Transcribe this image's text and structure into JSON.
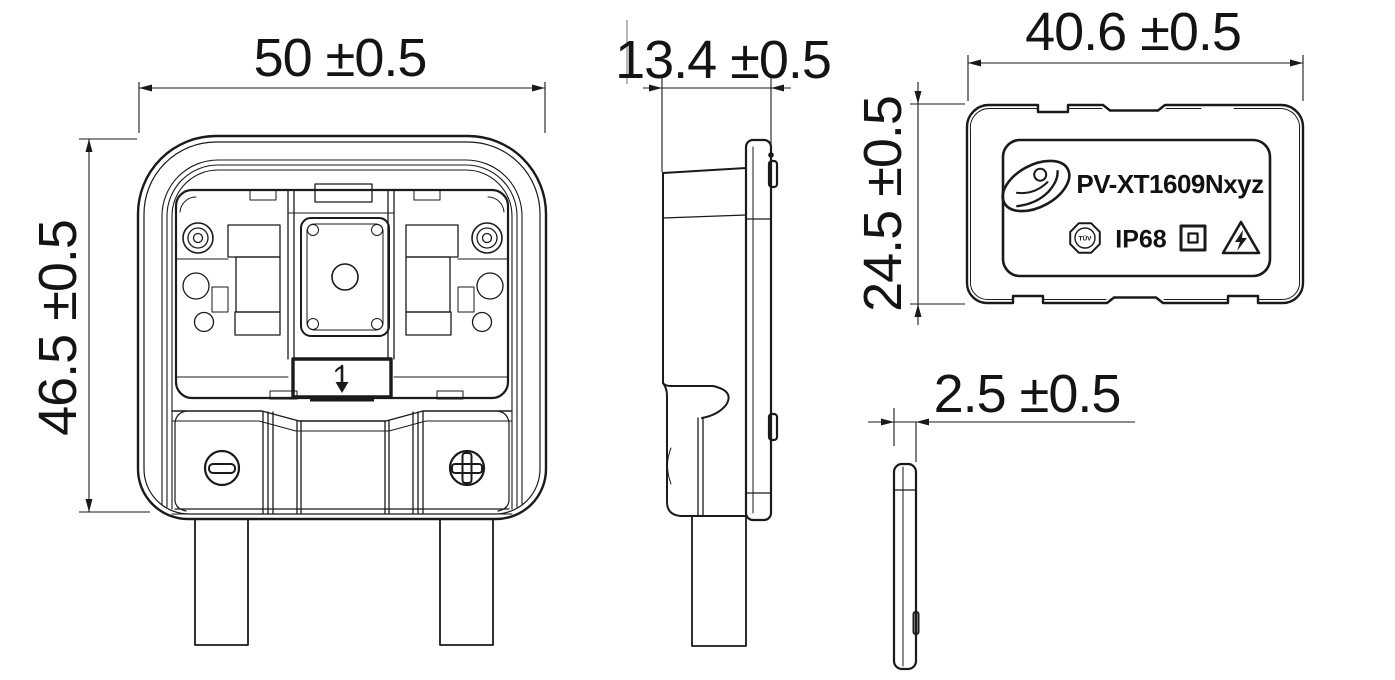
{
  "drawing": {
    "product": {
      "code": "PV-XT1609Nxyz",
      "ip_rating": "IP68",
      "tuv_mark": "TÜV"
    },
    "dimensions": {
      "front_width": "50 ±0.5",
      "front_height": "46.5 ±0.5",
      "side_depth": "13.4 ±0.5",
      "back_width": "40.6 ±0.5",
      "back_height": "24.5 ±0.5",
      "flange_thickness": "2.5 ±0.5"
    },
    "colors": {
      "line": "#1a1a1a",
      "background": "#ffffff",
      "construction_line": "#9a9a9a"
    }
  }
}
